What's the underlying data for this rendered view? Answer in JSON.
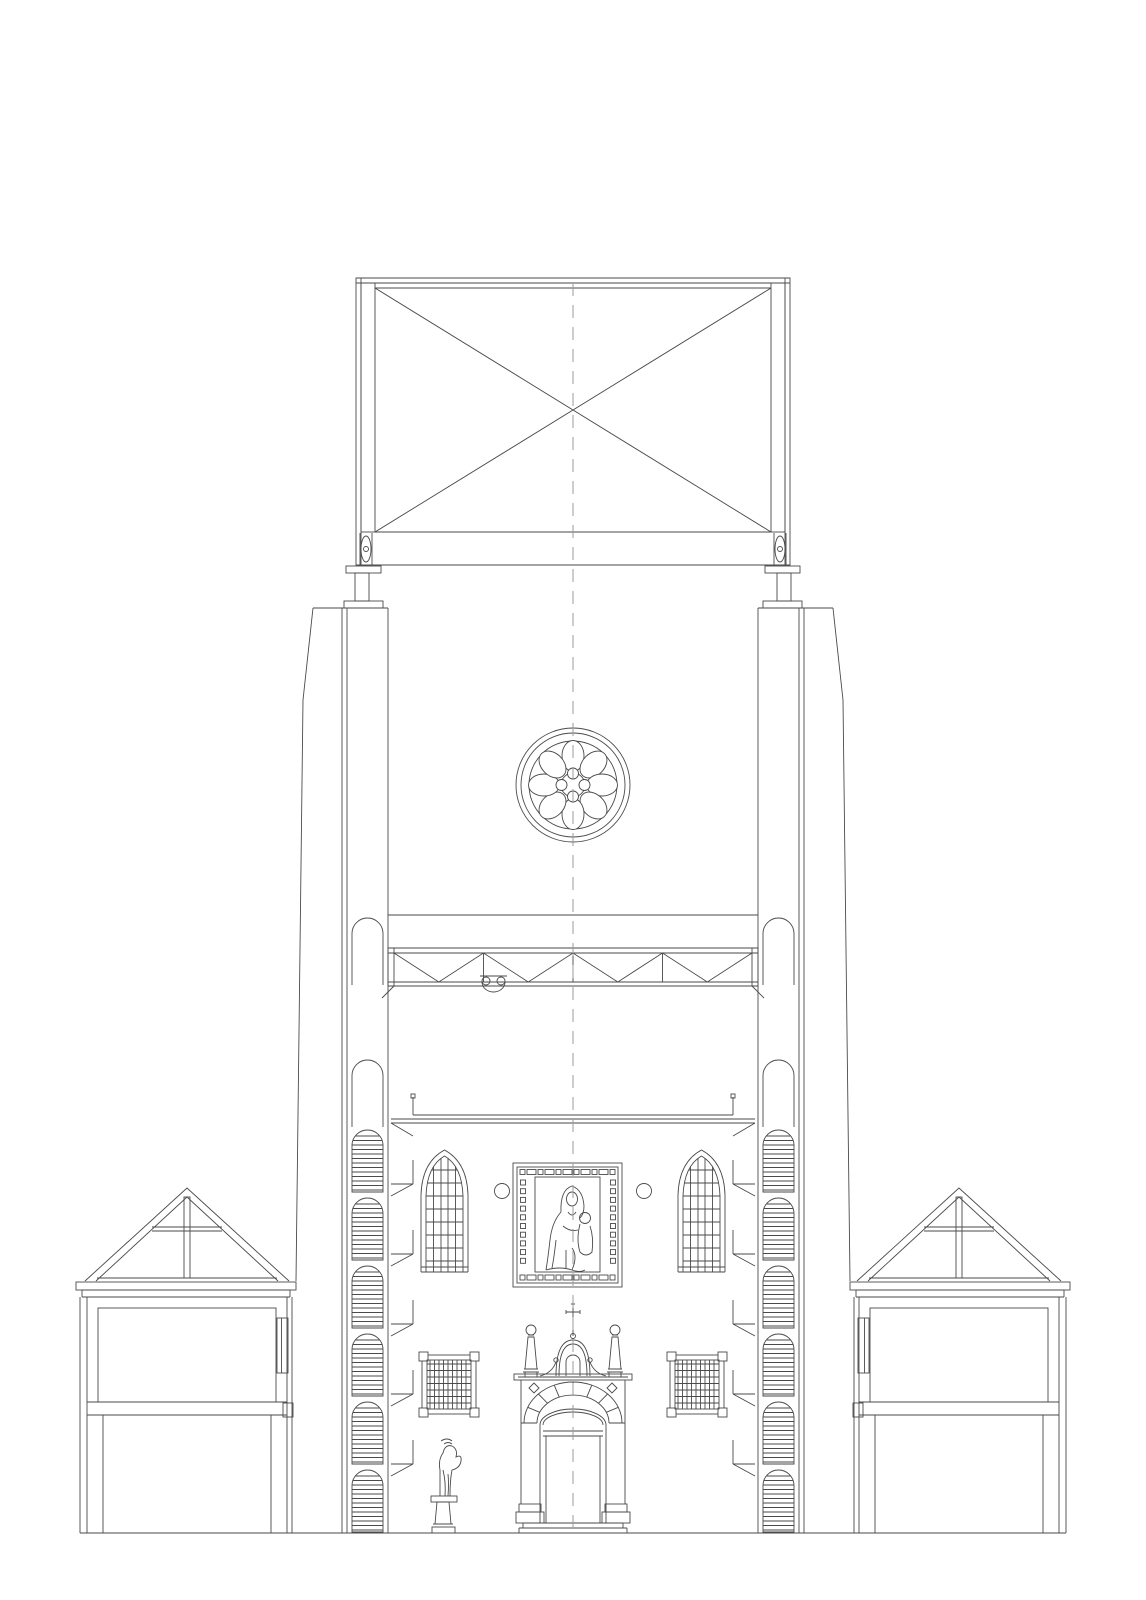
{
  "canvas": {
    "width": 1146,
    "height": 1600
  },
  "colors": {
    "line": "#4a4a4a",
    "dash": "#9b9b9b",
    "background": "#ffffff"
  },
  "drawing": {
    "type": "architectural-cross-section",
    "components": [
      "belfry-brace-frame",
      "bearing-pedestal-left",
      "bearing-pedestal-right",
      "tower-walls",
      "rose-window",
      "bell-truss",
      "truss-pulley-detail",
      "spiral-stair-left",
      "spiral-stair-right",
      "gallery-floor",
      "wall-brackets-left",
      "wall-brackets-right",
      "gothic-window-left",
      "gothic-window-right",
      "consecration-circle-left",
      "consecration-circle-right",
      "altarpiece-icon",
      "lattice-grille-left",
      "lattice-grille-right",
      "baroque-portal",
      "statue-on-column",
      "side-building-left",
      "side-building-right",
      "ground-line",
      "center-axis"
    ]
  }
}
